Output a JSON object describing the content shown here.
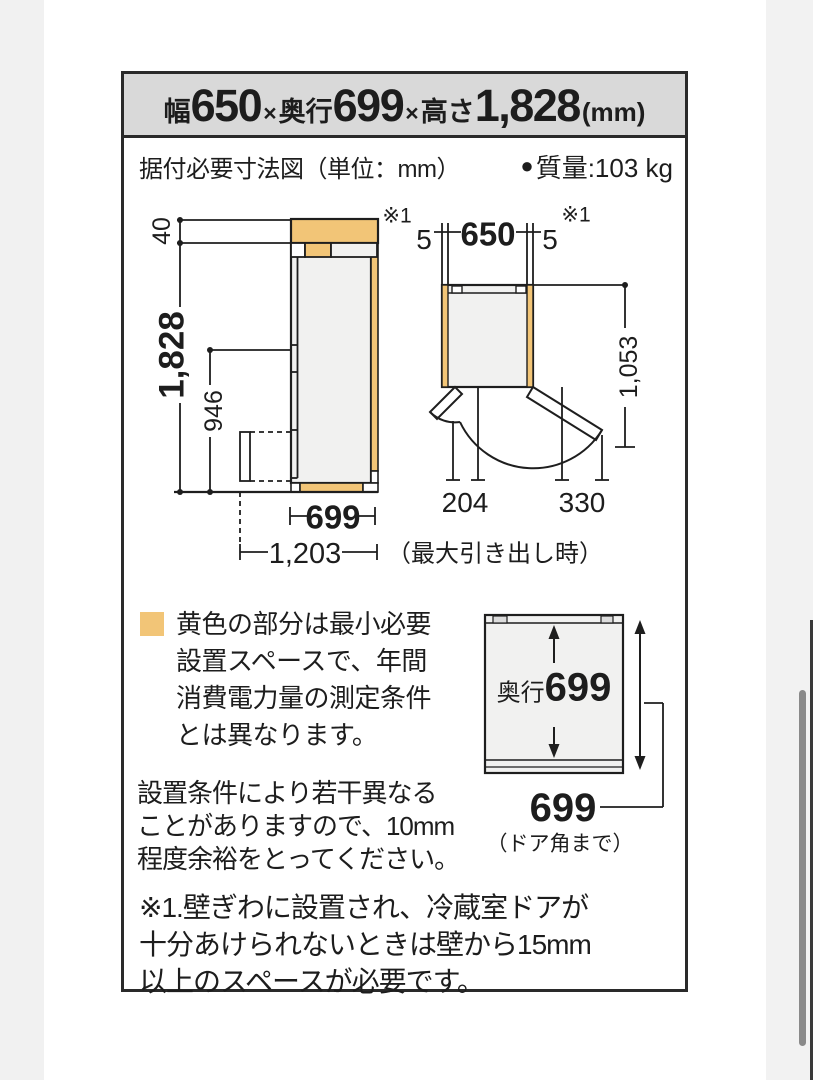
{
  "colors": {
    "accent_blue": "#0e67ae",
    "highlight_yellow": "#f2c577",
    "header_bg": "#d9d9d9",
    "line": "#1e1e1e",
    "scrollbar": "#8a8a8a"
  },
  "header": {
    "width_label": "幅",
    "width_value": "650",
    "times_1": "×",
    "depth_label": "奥行",
    "depth_value": "699",
    "times_2": "×",
    "height_label": "高さ",
    "height_value": "1,828",
    "unit": "(mm)"
  },
  "info_row": {
    "title": "据付必要寸法図（単位：mm）",
    "bullet": "●",
    "mass": "質量:103 kg"
  },
  "diagrams": {
    "side_view": {
      "top_clearance": "40",
      "height": "1,828",
      "pocket_height": "946",
      "depth": "699",
      "max_pullout": "1,203",
      "pullout_note": "（最大引き出し時）"
    },
    "top_view": {
      "wall_note_left": "※1",
      "wall_note_right": "※1",
      "gap_left": "5",
      "width": "650",
      "gap_right": "5",
      "open_depth": "1,053",
      "left_door_width": "204",
      "right_door_width": "330"
    },
    "depth_view": {
      "depth_label": "奥行",
      "depth_value": "699",
      "door_corner_value": "699",
      "door_corner_note": "（ドア角まで）"
    }
  },
  "legend": {
    "lines": [
      "黄色の部分は最小必要",
      "設置スペースで、年間",
      "消費電力量の測定条件",
      "とは異なります。"
    ]
  },
  "note": {
    "lines": [
      "設置条件により若干異なる",
      "ことがありますので、10mm",
      "程度余裕をとってください。"
    ]
  },
  "footnote": {
    "lines": [
      "※1.壁ぎわに設置され、冷蔵室ドアが",
      "十分あけられないときは壁から15mm",
      "以上のスペースが必要です。"
    ]
  }
}
